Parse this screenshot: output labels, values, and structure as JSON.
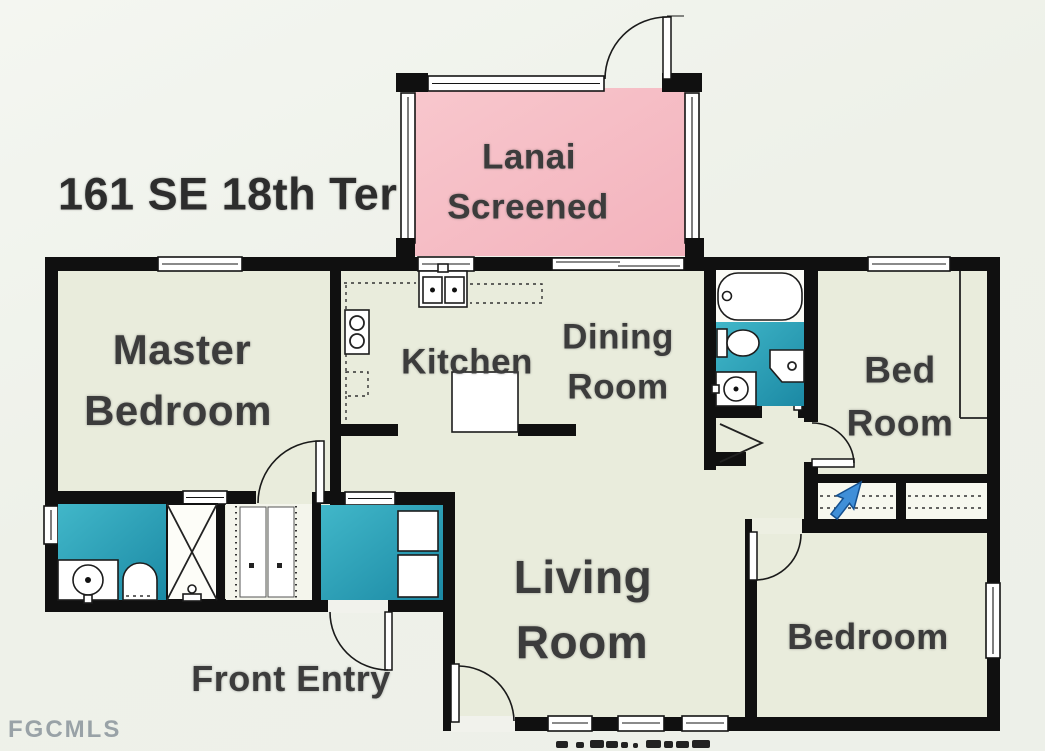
{
  "title": "161 SE 18th Ter",
  "watermark": "FGCMLS",
  "rooms": [
    {
      "id": "lanai",
      "lines": [
        "Lanai",
        "Screened"
      ]
    },
    {
      "id": "master-bedroom",
      "lines": [
        "Master",
        "Bedroom"
      ]
    },
    {
      "id": "kitchen",
      "lines": [
        "Kitchen"
      ]
    },
    {
      "id": "dining-room",
      "lines": [
        "Dining",
        "Room"
      ]
    },
    {
      "id": "bed-room",
      "lines": [
        "Bed",
        "Room"
      ]
    },
    {
      "id": "living-room",
      "lines": [
        "Living",
        "Room"
      ]
    },
    {
      "id": "bedroom",
      "lines": [
        "Bedroom"
      ]
    },
    {
      "id": "front-entry",
      "lines": [
        "Front Entry"
      ]
    }
  ],
  "colors": {
    "wall": "#101010",
    "room_fill": "#e9ecdc",
    "lanai_fill": "#f6c0c7",
    "wet_area_teal": "#2ba2bb",
    "background": "#edf0e9",
    "label_text": "#3c3c3c",
    "cursor_blue": "#3f8fd8",
    "watermark_gray": "#8b959c"
  }
}
